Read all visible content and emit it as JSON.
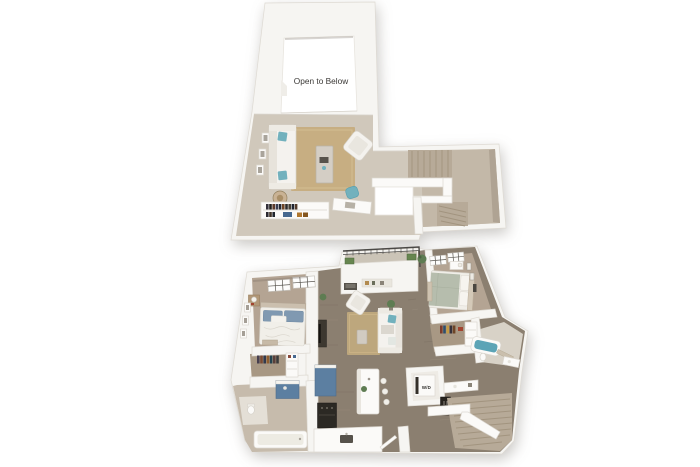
{
  "upper_plan": {
    "open_to_below_label": "Open to Below"
  },
  "lower_plan": {
    "washer_dryer_label": "W/D"
  },
  "palette": {
    "background": "#ffffff",
    "wall": "#f6f5f2",
    "wall_edge": "#dedad3",
    "loft_floor": "#d0c8bb",
    "loft_floor_dark": "#c3b8a8",
    "stair_tread": "#b7aa98",
    "carpet": "#b4a493",
    "carpet_dark": "#a89884",
    "wood": "#8b7f70",
    "tile": "#c6bbac",
    "rug": "#c7ae82",
    "rug_lower": "#bda77d",
    "teal": "#72b1bd",
    "teal_dark": "#5ca4b6",
    "cabinet_blue": "#5c7fa1",
    "pillow_blue": "#8099b1",
    "sage": "#b6bdad",
    "plant": "#5e7c52",
    "railing": "#4b4946",
    "dark_item": "#2e2b27",
    "furniture_white": "#f4f2ee",
    "text": "#3b3936"
  }
}
